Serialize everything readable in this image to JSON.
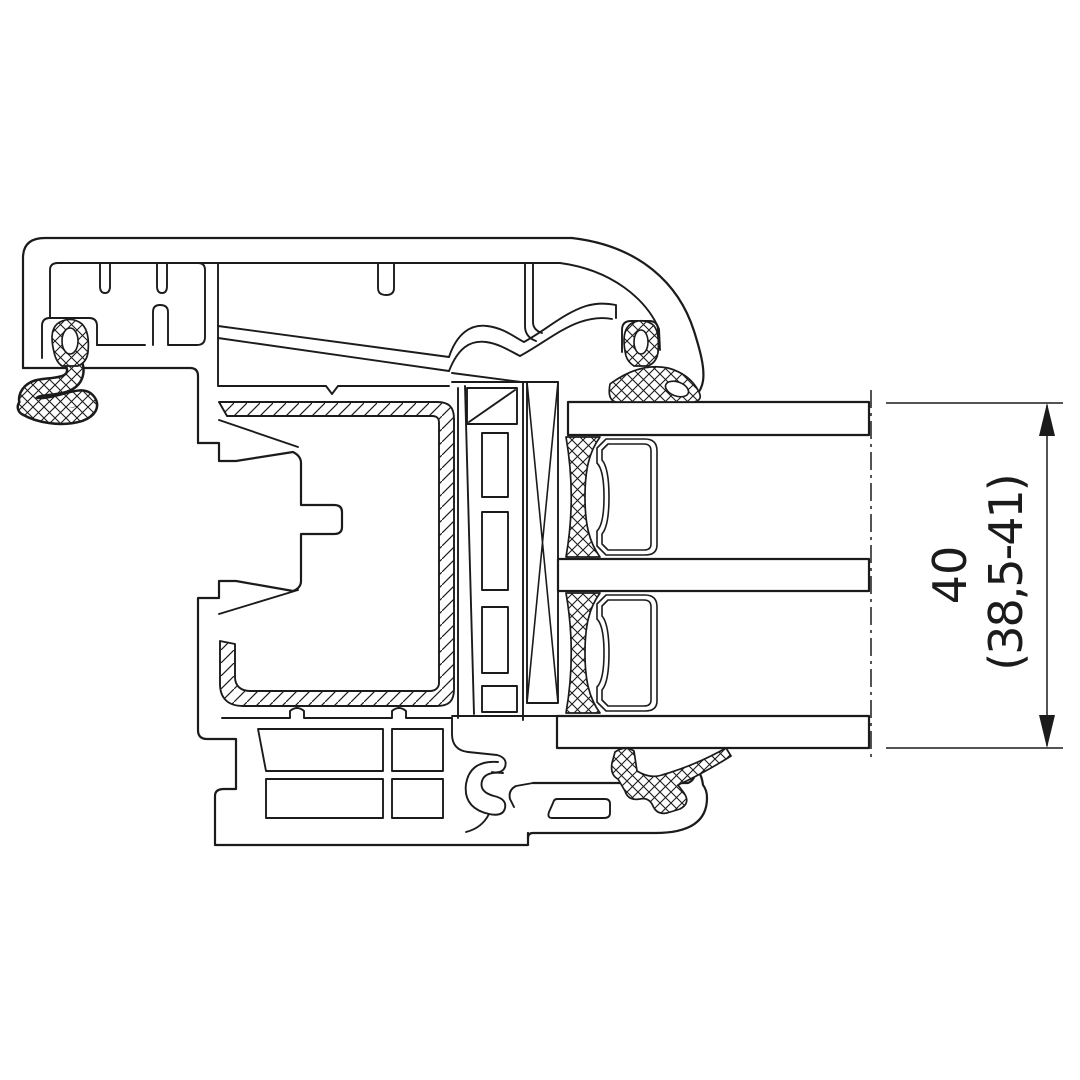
{
  "dimension": {
    "value": "40",
    "tolerance": "(38,5-41)"
  },
  "colors": {
    "line": "#1b1b1b",
    "background": "#ffffff"
  }
}
